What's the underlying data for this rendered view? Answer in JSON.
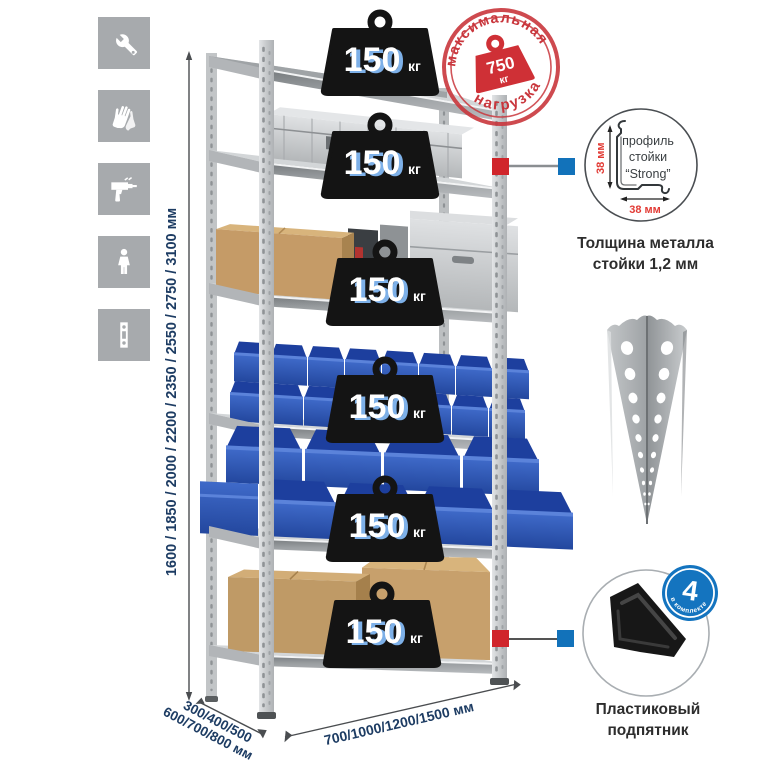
{
  "colors": {
    "accent_red": "#d0252b",
    "accent_blue": "#1272ba",
    "dimension_text_blue": "#1d3c63",
    "icon_tile_bg": "#a7aaad",
    "stamp_red": "#c9363c",
    "weight_black": "#141414",
    "bin_blue": "#2e57b5",
    "cardboard": "#c49a66",
    "metal_gray": "#cfd2d4"
  },
  "left_icons": [
    {
      "name": "wrench-icon"
    },
    {
      "name": "gloves-icon"
    },
    {
      "name": "drill-icon"
    },
    {
      "name": "person-icon"
    },
    {
      "name": "rack-post-icon"
    }
  ],
  "height_dimension": {
    "label": "1600 / 1850 / 2000 / 2200 / 2350 / 2550 / 2750 / 3100 мм"
  },
  "depth_dimension": {
    "line1": "300/400/500",
    "line2": "600/700/800 мм"
  },
  "width_dimension": {
    "label": "700/1000/1200/1500 мм"
  },
  "max_load_stamp": {
    "arc_top": "максимальная",
    "arc_bottom": "нагрузка",
    "value": "750",
    "unit": "кг"
  },
  "rack": {
    "shelves": [
      {
        "load": "150",
        "unit": "кг",
        "contents": "empty-top-shelf"
      },
      {
        "load": "150",
        "unit": "кг",
        "contents": "aluminum-case"
      },
      {
        "load": "150",
        "unit": "кг",
        "contents": "cardboard-box-and-aluminum-cases"
      },
      {
        "load": "150",
        "unit": "кг",
        "contents": "small-blue-bins"
      },
      {
        "load": "150",
        "unit": "кг",
        "contents": "large-blue-bins"
      },
      {
        "load": "150",
        "unit": "кг",
        "contents": "cardboard-boxes"
      }
    ]
  },
  "profile_detail": {
    "label_line1": "профиль",
    "label_line2": "стойки",
    "label_line3": "“Strong”",
    "vertical_dim": "38 мм",
    "horizontal_dim": "38 мм",
    "caption_line1": "Толщина металла",
    "caption_line2": "стойки 1,2 мм"
  },
  "foot_detail": {
    "badge_value": "4",
    "badge_label": "в комплекте",
    "caption_line1": "Пластиковый",
    "caption_line2": "подпятник"
  }
}
